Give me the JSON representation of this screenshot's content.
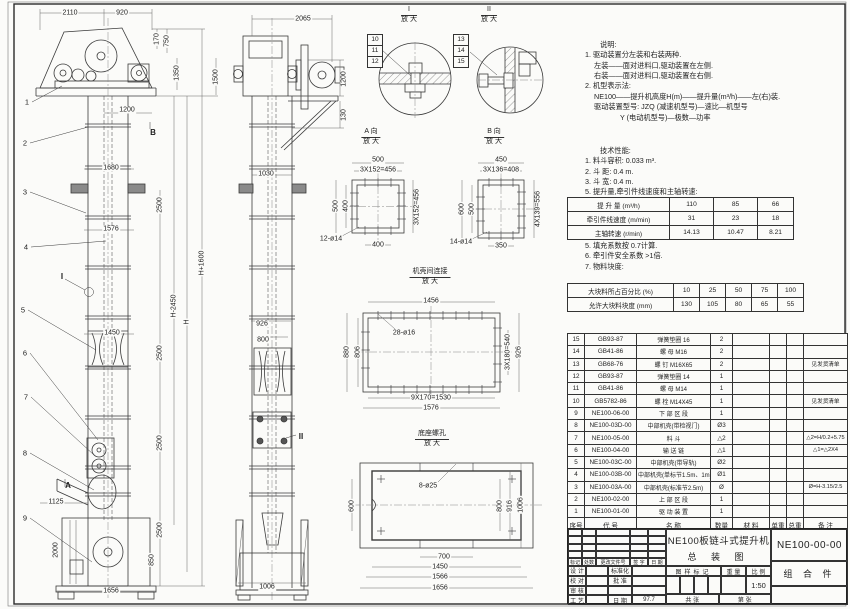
{
  "notes": {
    "heading": "说明:",
    "items": [
      "1. 驱动装置分左装和右装两种.",
      "左装——面对进料口,驱动装置在左侧.",
      "右装——面对进料口,驱动装置在右侧.",
      "2. 机型表示法:",
      "NE100——提升机高度H(m)——提升量(m³/h)——左(右)装.",
      "驱动装置型号: JZQ (减速机型号)—速比—机型号",
      "Y (电动机型号)—极数—功率"
    ]
  },
  "tech": {
    "heading": "技术性能:",
    "items_before": [
      "1. 料斗容积: 0.033 m³.",
      "2. 斗   距: 0.4 m.",
      "3. 斗   宽: 0.4 m.",
      "5. 提升量,牵引件线速度和主轴转速:"
    ],
    "perf_rows": [
      [
        "提 升 量  (m³/h)",
        "110",
        "85",
        "66"
      ],
      [
        "牵引件线速度 (m/min)",
        "31",
        "23",
        "18"
      ],
      [
        "主轴转速 (r/min)",
        "14.13",
        "10.47",
        "8.21"
      ]
    ],
    "items_after": [
      "5. 填充系数按 0.7计算.",
      "6. 牵引件安全系数 >1倍.",
      "7. 物料块度:"
    ],
    "lump_rows": [
      [
        "大块料所占百分比 (%)",
        "10",
        "25",
        "50",
        "75",
        "100"
      ],
      [
        "允许大块料块度 (mm)",
        "130",
        "105",
        "80",
        "65",
        "55"
      ]
    ]
  },
  "bom": {
    "headers": [
      "序号",
      "代  号",
      "名    称",
      "数量",
      "材  料",
      "单重",
      "总重",
      "备  注"
    ],
    "rows": [
      {
        "no": "15",
        "code": "GB93-87",
        "name": "弹簧垫圈 16",
        "qty": "2",
        "mat": "",
        "uw": "",
        "tw": "",
        "note": ""
      },
      {
        "no": "14",
        "code": "GB41-86",
        "name": "螺 母 M16",
        "qty": "2",
        "mat": "",
        "uw": "",
        "tw": "",
        "note": ""
      },
      {
        "no": "13",
        "code": "GB68-76",
        "name": "螺 钉 M16X65",
        "qty": "2",
        "mat": "",
        "uw": "",
        "tw": "",
        "note": "见发货清单"
      },
      {
        "no": "12",
        "code": "GB93-87",
        "name": "弹簧垫圈 14",
        "qty": "1",
        "mat": "",
        "uw": "",
        "tw": "",
        "note": ""
      },
      {
        "no": "11",
        "code": "GB41-86",
        "name": "螺 母 M14",
        "qty": "1",
        "mat": "",
        "uw": "",
        "tw": "",
        "note": ""
      },
      {
        "no": "10",
        "code": "GB5782-86",
        "name": "螺 栓 M14X45",
        "qty": "1",
        "mat": "",
        "uw": "",
        "tw": "",
        "note": "见发货清单"
      },
      {
        "no": "9",
        "code": "NE100-06-00",
        "name": "下 部 区 段",
        "qty": "1",
        "mat": "",
        "uw": "",
        "tw": "",
        "note": ""
      },
      {
        "no": "8",
        "code": "NE100-03D-00",
        "name": "中部机壳(带检视门)",
        "qty": "Ø3",
        "mat": "",
        "uw": "",
        "tw": "",
        "note": ""
      },
      {
        "no": "7",
        "code": "NE100-05-00",
        "name": "料  斗",
        "qty": "△2",
        "mat": "",
        "uw": "",
        "tw": "",
        "note": "△2=H/0.2+5.75"
      },
      {
        "no": "6",
        "code": "NE100-04-00",
        "name": "输 送 链",
        "qty": "△1",
        "mat": "",
        "uw": "",
        "tw": "",
        "note": "△1=△2X4"
      },
      {
        "no": "5",
        "code": "NE100-03C-00",
        "name": "中部机壳(带导轨)",
        "qty": "Ø2",
        "mat": "",
        "uw": "",
        "tw": "",
        "note": ""
      },
      {
        "no": "4",
        "code": "NE100-03B-00",
        "name": "中部机壳(单标节1.5m、1m)",
        "qty": "Ø1",
        "mat": "",
        "uw": "",
        "tw": "",
        "note": ""
      },
      {
        "no": "3",
        "code": "NE100-03A-00",
        "name": "中部机壳(标准节2.5m)",
        "qty": "Ø",
        "mat": "",
        "uw": "",
        "tw": "",
        "note": "Ø=H-3.15/2.5"
      },
      {
        "no": "2",
        "code": "NE100-02-00",
        "name": "上 部 区 段",
        "qty": "1",
        "mat": "",
        "uw": "",
        "tw": "",
        "note": ""
      },
      {
        "no": "1",
        "code": "NE100-01-00",
        "name": "驱 动 装 置",
        "qty": "1",
        "mat": "",
        "uw": "",
        "tw": "",
        "note": ""
      }
    ]
  },
  "title_block": {
    "revision_header": [
      "标记",
      "处数",
      "更改文件号",
      "签 字",
      "日 期"
    ],
    "rows": [
      [
        "设 计",
        "标准化",
        ""
      ],
      [
        "校 对",
        "批 准",
        ""
      ],
      [
        "审 核",
        "",
        ""
      ],
      [
        "工 艺",
        "日 期",
        "97.7"
      ]
    ],
    "title1": "NE100板链斗式提升机",
    "title2": "总 装 图",
    "drawing_no": "NE100-00-00",
    "part_type": "组 合 件",
    "mark_header": [
      "图样标记",
      "重 量",
      "比 例"
    ],
    "scale": "1:50",
    "sheet1": "共  张",
    "sheet2": "第  张"
  },
  "labels": {
    "front": [
      "2110",
      "920",
      "170",
      "750",
      "1350",
      "1500",
      "1200",
      "B",
      "1680",
      "2500",
      "1576",
      "I",
      "H-2450",
      "H",
      "H+1600",
      "1450",
      "2500",
      "A",
      "1125",
      "2000",
      "2500",
      "2500",
      "850",
      "1656"
    ],
    "front_balloons": [
      "1",
      "2",
      "3",
      "4",
      "5",
      "6",
      "7",
      "8",
      "9"
    ],
    "side": [
      "2065",
      "1200",
      "130",
      "1030",
      "926",
      "800",
      "II",
      "1006"
    ],
    "d1": {
      "title": "I",
      "sub": "放 大",
      "balloons": [
        "10",
        "11",
        "12"
      ]
    },
    "d2": {
      "title": "II",
      "sub": "放 大",
      "balloons": [
        "13",
        "14",
        "15"
      ]
    },
    "dA": {
      "title": "A 向",
      "sub": "放 大",
      "dims": [
        "500",
        "3X152=456",
        "500",
        "400",
        "400",
        "12-ø14",
        "3X152=456"
      ]
    },
    "dB": {
      "title": "B 向",
      "sub": "放 大",
      "dims": [
        "450",
        "3X136=408",
        "600",
        "500",
        "350",
        "14-ø14",
        "4X139=556"
      ]
    },
    "dC": {
      "title": "机壳间连接",
      "sub": "放 大",
      "dims": [
        "1456",
        "28-ø16",
        "880",
        "806",
        "3X180=540",
        "926",
        "9X170=1530",
        "1576"
      ]
    },
    "dD": {
      "title": "底座螺孔",
      "sub": "放 大",
      "dims": [
        "8-ø25",
        "600",
        "800",
        "916",
        "1006",
        "700",
        "1450",
        "1566",
        "1656"
      ]
    }
  }
}
